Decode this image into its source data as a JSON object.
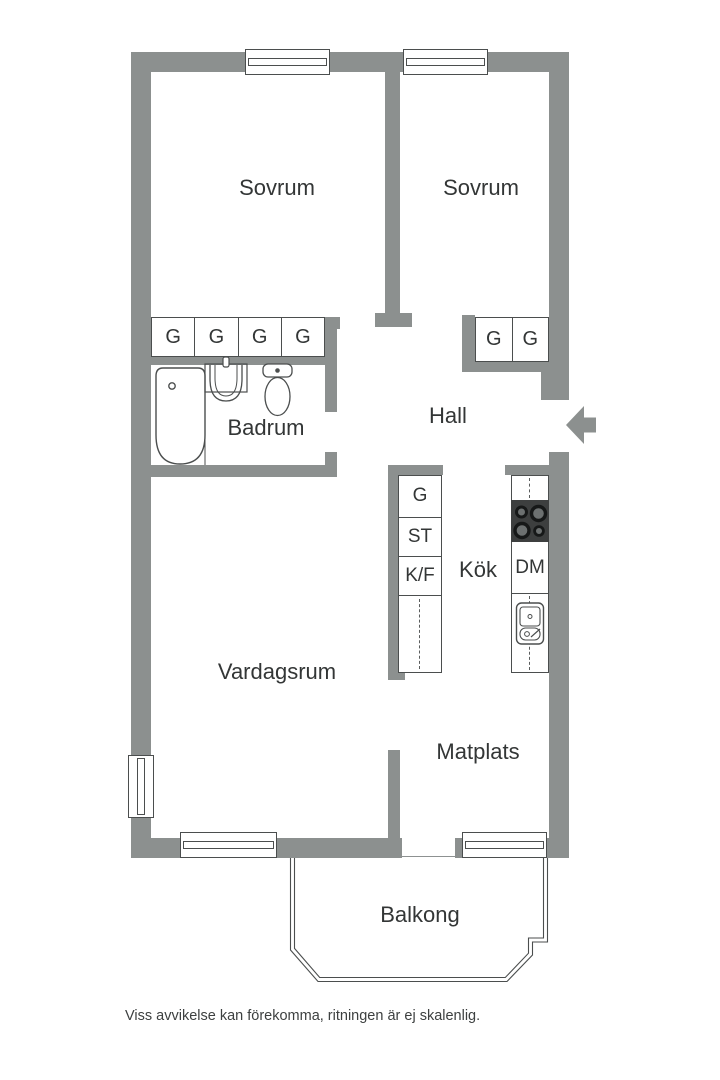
{
  "colors": {
    "wall": "#8c908f",
    "line": "#4b4e4e",
    "text": "#333636",
    "stove": "#3d3f3f",
    "dash": "#5a5d5d"
  },
  "rooms": {
    "bedroom1": "Sovrum",
    "bedroom2": "Sovrum",
    "bathroom": "Badrum",
    "hall": "Hall",
    "kitchen": "Kök",
    "living_room": "Vardagsrum",
    "dining": "Matplats",
    "balcony": "Balkong"
  },
  "storage": {
    "bedroom1_wardrobes": [
      "G",
      "G",
      "G",
      "G"
    ],
    "bedroom2_wardrobes": [
      "G",
      "G"
    ],
    "kitchen_tall_units": [
      "G",
      "ST",
      "K/F"
    ],
    "dishwasher": "DM"
  },
  "fixtures": [
    "bathtub",
    "bathroom-sink",
    "toilet",
    "stove",
    "kitchen-sink",
    "entrance-arrow"
  ],
  "footer": {
    "disclaimer": "Viss avvikelse kan förekomma, ritningen är ej skalenlig."
  }
}
